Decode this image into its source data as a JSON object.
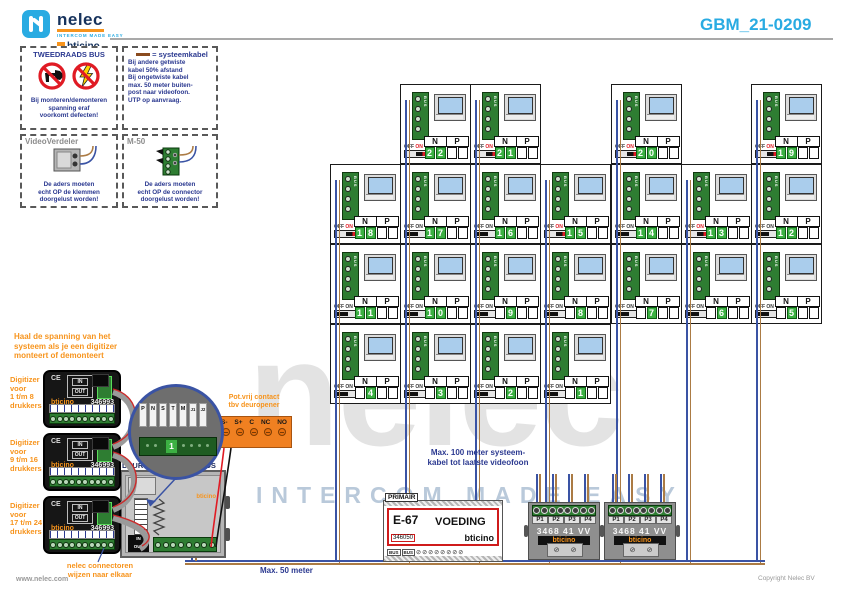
{
  "colors": {
    "blue_wire": "#3a53a4",
    "brown_wire": "#ab7b44",
    "accent_cyan": "#29abe2",
    "note_blue": "#2b3990",
    "orange": "#f7941d",
    "digit_green": "#3cb043",
    "red": "#e01b24"
  },
  "header": {
    "brand": "nelec",
    "brand_tagline": "intercom made easy",
    "partner_brand": "bticino",
    "doc_number": "GBM_21-0209"
  },
  "legend": {
    "bus_box": {
      "title": "TWEEDRAADS BUS",
      "lines": [
        "Bij monteren/demonteren",
        "spanning eraf",
        "voorkomt defecten!"
      ]
    },
    "cable_box": {
      "title": "= systeemkabel",
      "lines": [
        "Bij andere getwiste",
        "kabel 50% afstand",
        "Bij ongetwiste kabel",
        "max. 50 meter buiten-",
        "post naar videofoon.",
        "UTP op aanvraag."
      ]
    },
    "verdeler_box": {
      "title": "VideoVerdeler",
      "lines": [
        "De aders moeten",
        "echt OP de klemmen",
        "doorgelust worden!"
      ]
    },
    "m50_box": {
      "title": "M-50",
      "lines": [
        "De aders moeten",
        "echt OP de connector",
        "doorgelust worden!"
      ]
    }
  },
  "grid": {
    "n_label": "N",
    "p_label": "P",
    "off_label": "OFF",
    "on_label": "ON",
    "bus_label": "BUS",
    "units": [
      {
        "n": "22",
        "col": 2,
        "row": 1,
        "on": true
      },
      {
        "n": "21",
        "col": 3,
        "row": 1,
        "on": true
      },
      {
        "n": "20",
        "col": 5,
        "row": 1,
        "on": true
      },
      {
        "n": "19",
        "col": 7,
        "row": 1,
        "on": true
      },
      {
        "n": "18",
        "col": 1,
        "row": 2,
        "on": true
      },
      {
        "n": "17",
        "col": 2,
        "row": 2,
        "on": false
      },
      {
        "n": "16",
        "col": 3,
        "row": 2,
        "on": false
      },
      {
        "n": "15",
        "col": 4,
        "row": 2,
        "on": true
      },
      {
        "n": "14",
        "col": 5,
        "row": 2,
        "on": false
      },
      {
        "n": "13",
        "col": 6,
        "row": 2,
        "on": true
      },
      {
        "n": "12",
        "col": 7,
        "row": 2,
        "on": false
      },
      {
        "n": "11",
        "col": 1,
        "row": 3,
        "on": false
      },
      {
        "n": "10",
        "col": 2,
        "row": 3,
        "on": false
      },
      {
        "n": "9",
        "col": 3,
        "row": 3,
        "on": false
      },
      {
        "n": "8",
        "col": 4,
        "row": 3,
        "on": false
      },
      {
        "n": "7",
        "col": 5,
        "row": 3,
        "on": false
      },
      {
        "n": "6",
        "col": 6,
        "row": 3,
        "on": false
      },
      {
        "n": "5",
        "col": 7,
        "row": 3,
        "on": false
      },
      {
        "n": "4",
        "col": 1,
        "row": 4,
        "on": false
      },
      {
        "n": "3",
        "col": 2,
        "row": 4,
        "on": false
      },
      {
        "n": "2",
        "col": 3,
        "row": 4,
        "on": false
      },
      {
        "n": "1",
        "col": 4,
        "row": 4,
        "on": false
      }
    ]
  },
  "left_notes": {
    "digitizer_warning": [
      "Haal de spanning van het",
      "systeem als je een digitizer",
      "monteert of demonteert"
    ],
    "connector_note": [
      "nelec connectoren",
      "wijzen naar elkaar"
    ]
  },
  "digitizers": [
    {
      "label": [
        "Digitizer",
        "voor",
        "1 t/m 8",
        "drukkers"
      ],
      "brand": "bticino",
      "model": "346993",
      "ce": "CE",
      "in_label": "IN",
      "out_label": "OUT"
    },
    {
      "label": [
        "Digitizer",
        "voor",
        "9 t/m 16",
        "drukkers"
      ],
      "brand": "bticino",
      "model": "346993",
      "ce": "CE",
      "in_label": "IN",
      "out_label": "OUT"
    },
    {
      "label": [
        "Digitizer",
        "voor",
        "17 t/m 24",
        "drukkers"
      ],
      "brand": "bticino",
      "model": "346993",
      "ce": "CE",
      "in_label": "IN",
      "out_label": "OUT"
    }
  ],
  "door_station": {
    "title": "DEURSTATION 2-DRAADS",
    "brand": "bticino",
    "in_label": "IN",
    "out_label": "OUT"
  },
  "magnifier": {
    "pins": [
      "P",
      "N",
      "S",
      "T",
      "M",
      "J1",
      "J2"
    ],
    "digit": "1"
  },
  "door_contact": {
    "label": [
      "Pot.vrij contact",
      "tbv deuropener"
    ],
    "terminals": [
      "S-",
      "S+",
      "C",
      "NC",
      "NO"
    ]
  },
  "power_supply": {
    "panel_label": "PRIMAIR",
    "model": "E-67",
    "name": "VOEDING",
    "article": "346050",
    "brand": "bticino",
    "terminal_labels": [
      "BUS",
      "BUS"
    ]
  },
  "distributor": {
    "ports": [
      "P1",
      "P2",
      "P3",
      "P4"
    ],
    "model": "3468 41 VV",
    "brand": "bticino"
  },
  "wiring_notes": {
    "max100": [
      "Max. 100 meter systeem-",
      "kabel tot laatste videofoon"
    ],
    "max50": "Max. 50 meter"
  },
  "watermark": {
    "text": "nelec",
    "tagline": "INTERCOM MADE EASY"
  },
  "footer": {
    "site": "www.nelec.com",
    "copyright": "Copyright Nelec BV"
  }
}
